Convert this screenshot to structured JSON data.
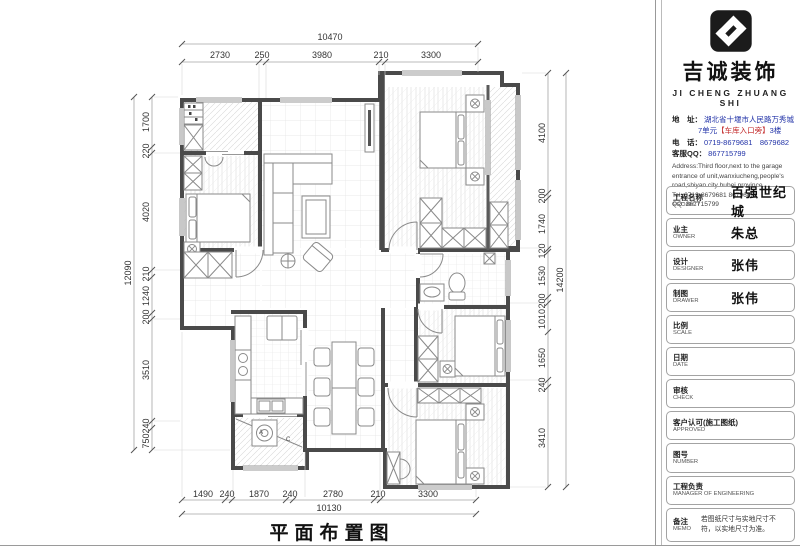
{
  "plan": {
    "title": "平面布置图",
    "label_a": "A",
    "label_c": "C"
  },
  "dims": {
    "top": {
      "overall": "10470",
      "segments": [
        "2730",
        "250",
        "3980",
        "210",
        "3300"
      ]
    },
    "left": {
      "overall": "12090",
      "segments": [
        "1700",
        "220",
        "4020",
        "210",
        "1240",
        "200",
        "3510",
        "240",
        "750"
      ]
    },
    "right": {
      "overall": "14200",
      "segments": [
        "4100",
        "200",
        "1740",
        "120",
        "1530",
        "200",
        "1010",
        "1650",
        "240",
        "3410"
      ]
    },
    "bottom": {
      "overall": "10130",
      "segments": [
        "1490",
        "240",
        "1870",
        "240",
        "2780",
        "210",
        "3300"
      ]
    }
  },
  "company": {
    "name": "吉诚装饰",
    "name_en": "JI CHENG ZHUANG SHI",
    "addr_label": "地　址：",
    "addr_line1": "湖北省十堰市人民路万秀城",
    "addr_line2_pre": "7单元",
    "addr_line2_mid": "【车库入口旁】",
    "addr_line2_post": "3楼",
    "tel_label": "电　话：",
    "tel_value": "0719-8679681　8679682",
    "qq_label": "客服QQ：",
    "qq_value": "867715799",
    "en_address": "Address:Third floor,next to the garage entrance of unit,wanxiucheng,people's road,shiyan city hubei province",
    "en_tel": "Tel: 0719-8679681    8679682",
    "en_qq": "QQ: 867715799"
  },
  "fields": [
    {
      "zh": "工程名称",
      "en": "PROJECT",
      "value": "百强世纪城"
    },
    {
      "zh": "业主",
      "en": "OWNER",
      "value": "朱总"
    },
    {
      "zh": "设计",
      "en": "DESIGNER",
      "value": "张伟"
    },
    {
      "zh": "制图",
      "en": "DRAWER",
      "value": "张伟"
    },
    {
      "zh": "比例",
      "en": "SCALE",
      "value": ""
    },
    {
      "zh": "日期",
      "en": "DATE",
      "value": ""
    },
    {
      "zh": "审核",
      "en": "CHECK",
      "value": ""
    },
    {
      "zh": "客户认可(施工图纸)",
      "en": "APPROVED",
      "value": ""
    },
    {
      "zh": "图号",
      "en": "NUMBER",
      "value": ""
    },
    {
      "zh": "工程负责",
      "en": "MANAGER OF ENGINEERING",
      "value": ""
    },
    {
      "zh": "备注",
      "en": "MEMO",
      "value": "若图纸尺寸与实地尺寸不符，以实地尺寸为准。"
    }
  ],
  "colors": {
    "accent_blue": "#2233a8",
    "accent_red": "#c22525",
    "wall": "#4a4a4a"
  }
}
